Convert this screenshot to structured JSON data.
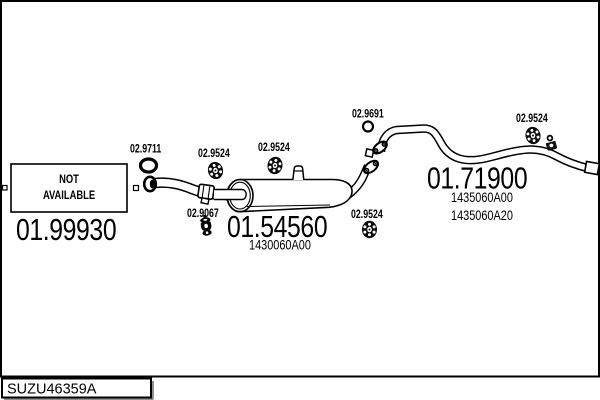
{
  "colors": {
    "ink": "#000000",
    "paper": "#ffffff",
    "shadow": "#909090"
  },
  "diagram_code": "SUZU46359A",
  "labels": {
    "not_available_line1": "NOT",
    "not_available_line2": "AVAILABLE"
  },
  "parts": {
    "front_exhaust": {
      "number": "01.99930"
    },
    "front_gasket": {
      "number": "02.9711"
    },
    "clamp_front": {
      "number": "02.9524"
    },
    "clamp_mid": {
      "number": "02.9524"
    },
    "rubber_hanger": {
      "number": "02.9067"
    },
    "muffler": {
      "number": "01.54560",
      "oem": "1430060A00"
    },
    "clamp_rear": {
      "number": "02.9524"
    },
    "rear_gasket": {
      "number": "02.9691"
    },
    "tailpipe": {
      "number": "01.71900",
      "oem1": "1435060A00",
      "oem2": "1435060A20"
    },
    "clamp_tail": {
      "number": "02.9524"
    }
  }
}
